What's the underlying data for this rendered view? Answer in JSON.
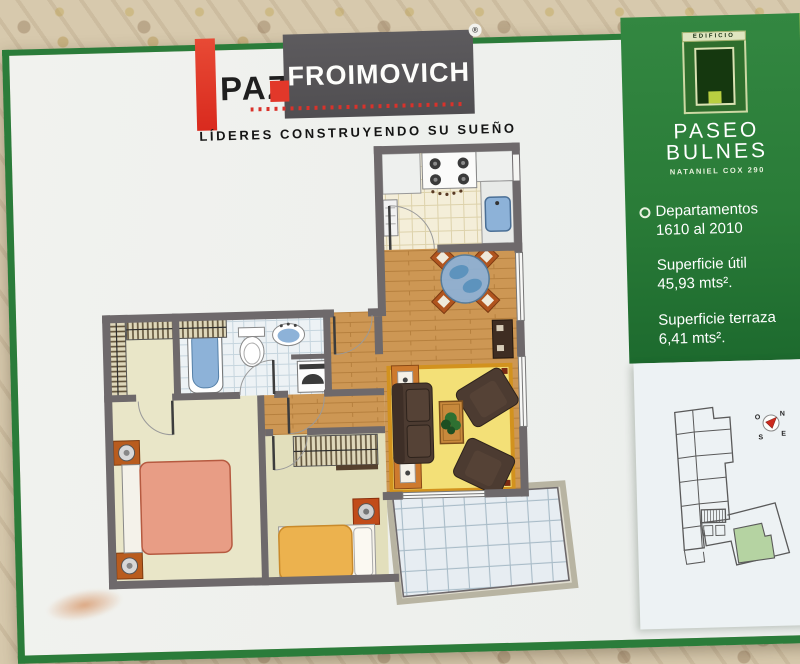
{
  "brand": {
    "word1": "PAZ",
    "word2": "FROIMOVICH",
    "registered": "®",
    "tagline": "LÍDERES CONSTRUYENDO SU SUEÑO",
    "bar_color": "#e2382a",
    "box_color": "#565456"
  },
  "building_panel": {
    "panel_color": "#2a7c38",
    "logo": {
      "top_label": "EDIFICIO",
      "name_line1": "PASEO",
      "name_line2": "BULNES",
      "address": "NATANIEL COX 290"
    },
    "details": [
      {
        "label": "Departamentos",
        "value": "1610 al 2010"
      },
      {
        "label": "Superficie útil",
        "value": "45,93 mts²."
      },
      {
        "label": "Superficie terraza",
        "value": "6,41 mts²."
      },
      {
        "label": "Superficie total",
        "value": "52,34 mts²."
      }
    ]
  },
  "siteplan": {
    "panel_color": "#edf2f4",
    "outline_color": "#5a5a5a",
    "highlight_color": "#b5d3a2",
    "compass": {
      "n": "N",
      "e": "E",
      "s": "S",
      "o": "O",
      "needle_color": "#cc2a1e"
    }
  },
  "floorplan": {
    "palette": {
      "wall": "#6e696b",
      "wood": "#cd9754",
      "wood_line": "#b27c3a",
      "kitchen_floor": "#f4eed9",
      "bath_floor": "#edf2f5",
      "bedroom_floor": "#e9e6c8",
      "bedroom2_floor": "#e2dfbc",
      "terrace_floor": "#e7edf2",
      "rug": "#f3e077",
      "rug_border": "#d2921e",
      "sofa": "#4c3b31",
      "sofa_seat": "#554236",
      "bed_main": "#e89d85",
      "bed_single": "#ecb24e",
      "fixture_blue": "#8db2d8",
      "nightstand": "#b95c1e",
      "table_wood": "#c8893c",
      "plant": "#2e7031"
    }
  }
}
